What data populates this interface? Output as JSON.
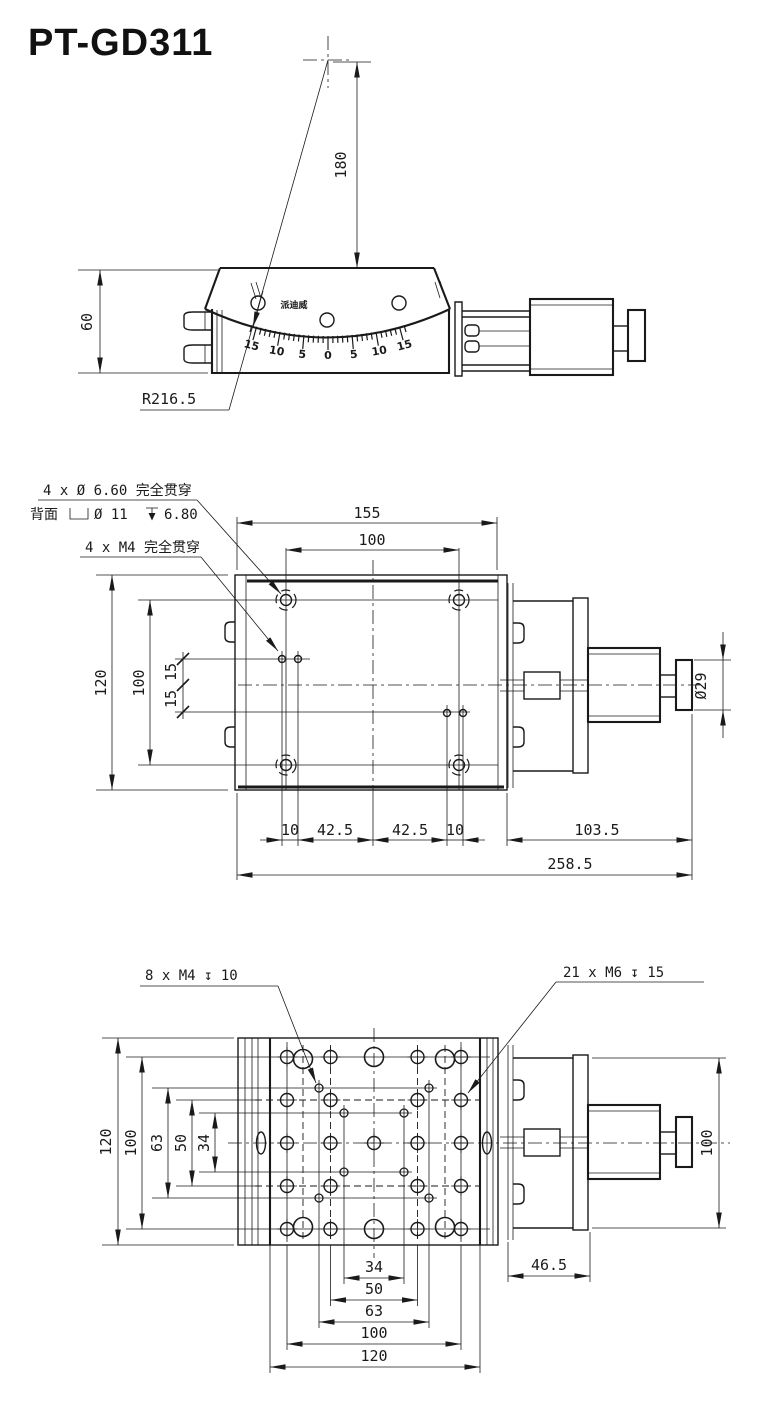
{
  "title": "PT-GD311",
  "line_color": "#1a1a1a",
  "side_view": {
    "brand": "派迪威",
    "scale_labels": [
      "15",
      "10",
      "5",
      "0",
      "5",
      "10",
      "15"
    ],
    "dim_180": "180",
    "dim_60": "60",
    "radius_label": "R216.5"
  },
  "plan_view": {
    "note_cbore_line1": "4 x Ø 6.60 完全贯穿",
    "note_cbore_back": "背面",
    "note_cbore_dia": "Ø 11",
    "note_cbore_depth": "6.80",
    "note_m4": "4 x M4 完全贯穿",
    "dim_155": "155",
    "dim_100_top": "100",
    "dim_120_left": "120",
    "dim_100_left": "100",
    "dim_15_upper": "15",
    "dim_15_lower": "15",
    "dim_10_left": "10",
    "dim_42_5_left": "42.5",
    "dim_42_5_right": "42.5",
    "dim_10_right": "10",
    "dim_103_5": "103.5",
    "dim_258_5": "258.5",
    "dim_dia_29": "Ø29"
  },
  "bottom_view": {
    "note_m4": "8 x M4 ↧ 10",
    "note_m6": "21 x M6 ↧ 15",
    "dim_120_left": "120",
    "dim_100_left": "100",
    "dim_63_left": "63",
    "dim_50_left": "50",
    "dim_34_left": "34",
    "dim_34_bottom": "34",
    "dim_50_bottom": "50",
    "dim_63_bottom": "63",
    "dim_100_bottom": "100",
    "dim_120_bottom": "120",
    "dim_46_5": "46.5",
    "dim_100_right": "100"
  }
}
